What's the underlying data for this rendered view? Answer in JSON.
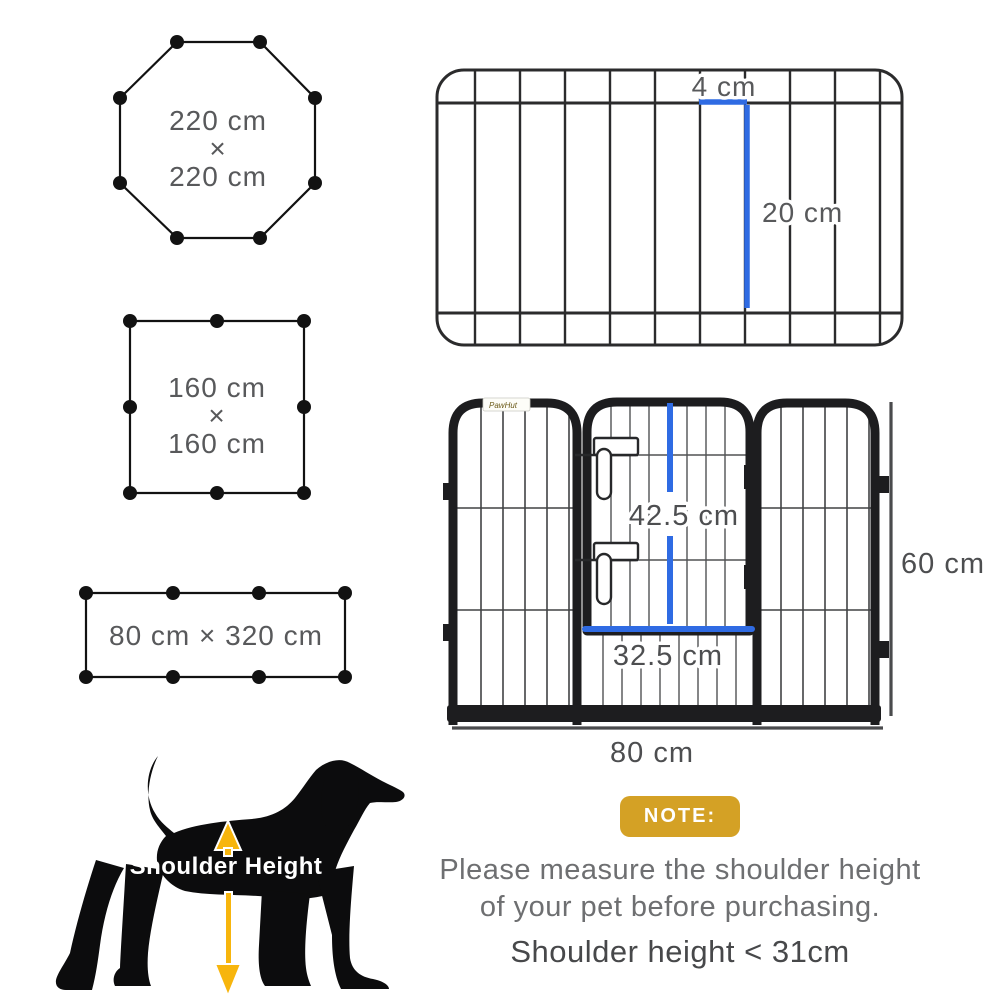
{
  "colors": {
    "measure_blue": "#2f6be3",
    "note_gold": "#d4a125",
    "arrow_yellow": "#f7b50d",
    "label_gray": "#58595b"
  },
  "shapes": {
    "octagon": {
      "dim1": "220 cm",
      "times": "×",
      "dim2": "220 cm"
    },
    "square": {
      "dim1": "160 cm",
      "times": "×",
      "dim2": "160 cm"
    },
    "rectangle": {
      "label": "80 cm × 320 cm"
    }
  },
  "top_view": {
    "gap_label": "4 cm",
    "height_label": "20 cm"
  },
  "front_view": {
    "brand": "PawHut",
    "door_height": "42.5 cm",
    "door_width": "32.5 cm",
    "panel_height": "60 cm",
    "panel_width": "80 cm"
  },
  "dog": {
    "label": "Shoulder Height"
  },
  "note": {
    "badge": "NOTE:",
    "line1": "Please measure the shoulder height",
    "line2": "of your pet before purchasing.",
    "line3": "Shoulder height < 31cm"
  }
}
